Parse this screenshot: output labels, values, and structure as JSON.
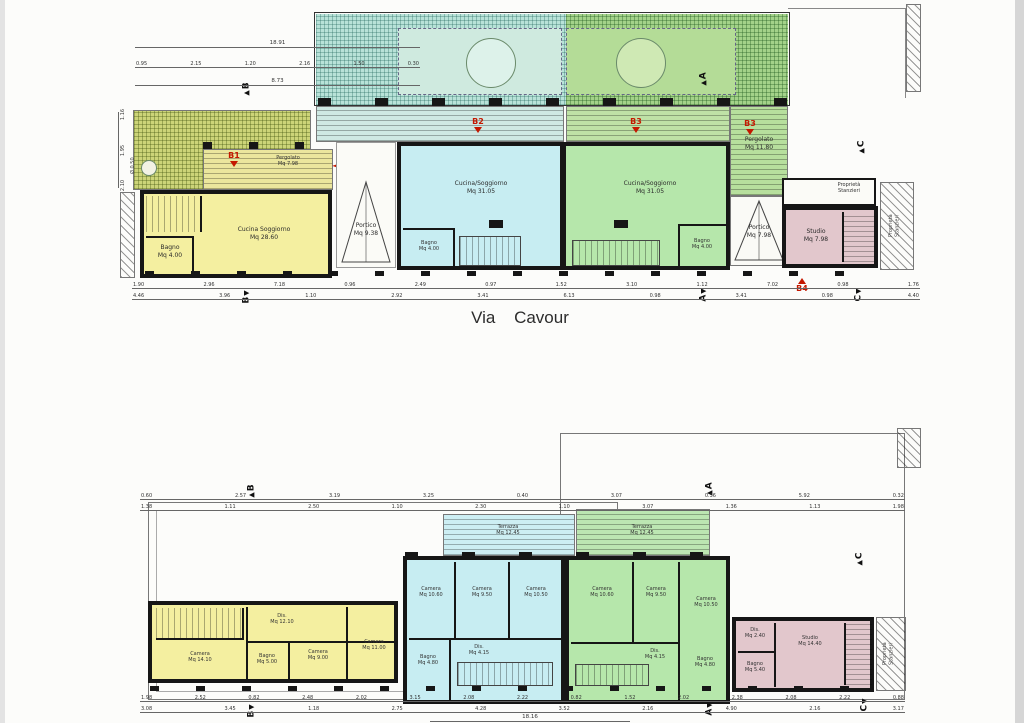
{
  "street": "Via Cavour",
  "sections": {
    "a": "A",
    "b": "B",
    "c": "C"
  },
  "unit_markers": {
    "b1": "B1",
    "b2": "B2",
    "b3": "B3",
    "b4": "B4"
  },
  "colors": {
    "unit_b1_yellow": "#f4efa0",
    "unit_b2_cyan": "#c7edf2",
    "unit_b3_green": "#b6e7ab",
    "unit_b4_pink": "#e2c7cc",
    "garden_green": "#a3d289",
    "garden_cyan": "#b8e2d8",
    "pergola_yellow": "#ccd478",
    "wall_black": "#161616",
    "marker_red": "#c41800"
  },
  "ground": {
    "b1_main": "Cucina Soggiorno\nMq 28.60",
    "b1_bagno": "Bagno\nMq 4.00",
    "b1_pergolato": "Pergolato\nMq 7.98",
    "b1_tree": "Ø 0.50",
    "portico_left": "Portico\nMq 9.38",
    "b2_main": "Cucina/Soggiorno\nMq 31.05",
    "b2_bagno": "Bagno\nMq 4.00",
    "b3_main": "Cucina/Soggiorno\nMq 31.05",
    "b3_bagno": "Bagno\nMq 4.00",
    "b3_pergolato": "Pergolato\nMq 11.80",
    "portico_right": "Portico\nMq 7.98",
    "b4_entry": "Proprietà\nStanzieri",
    "b4_studio": "Studio\nMq 7.98",
    "prop_right": "Proprietà\nStanzieri",
    "dim_total_top": "18.91",
    "dim_top_row": [
      "0.95",
      "2.15",
      "1.20",
      "2.16",
      "1.50",
      "0.30"
    ],
    "dim_top_sub": "8.73",
    "dim_left_col": [
      "1.16",
      "1.95",
      "2.10"
    ],
    "dim_bottom_row1": [
      "1.90",
      "2.96",
      "7.18",
      "0.96",
      "2.49",
      "0.97",
      "1.52",
      "3.10",
      "1.12",
      "7.02",
      "0.98",
      "1.76"
    ],
    "dim_bottom_row2": [
      "4.46",
      "3.96",
      "1.10",
      "2.92",
      "3.41",
      "6.13",
      "0.98",
      "3.41",
      "0.98",
      "4.40"
    ]
  },
  "first": {
    "terrace_b2": "Terrazza\nMq 12.45",
    "terrace_b3": "Terrazza\nMq 12.45",
    "y_dis": "Dis.\nMq 12.10",
    "y_camera1": "Camera\nMq 14.10",
    "y_bagno": "Bagno\nMq 5.00",
    "y_camera2": "Camera\nMq 9.00",
    "y_camera3": "Camera\nMq 11.00",
    "c_camera1": "Camera\nMq 10.60",
    "c_camera2": "Camera\nMq 9.50",
    "c_camera3": "Camera\nMq 10.50",
    "c_dis": "Dis.\nMq 4.15",
    "c_bagno": "Bagno\nMq 4.80",
    "g_camera1": "Camera\nMq 10.60",
    "g_camera2": "Camera\nMq 9.50",
    "g_camera3": "Camera\nMq 10.50",
    "g_dis": "Dis.\nMq 4.15",
    "g_bagno": "Bagno\nMq 4.80",
    "p_dis": "Dis.\nMq 2.40",
    "p_bagno": "Bagno\nMq 5.40",
    "p_studio": "Studio\nMq 14.40",
    "prop_right": "Proprietà\nStanzieri",
    "dim_top_row1": [
      "0.60",
      "2.57",
      "3.19",
      "3.25",
      "0.40",
      "3.07",
      "0.36",
      "5.92",
      "0.32"
    ],
    "dim_top_row2": [
      "1.38",
      "1.11",
      "2.50",
      "1.10",
      "2.30",
      "1.10",
      "3.07",
      "1.36",
      "1.13",
      "1.98"
    ],
    "dim_bottom_row1": [
      "1.98",
      "2.52",
      "0.82",
      "2.48",
      "2.02",
      "3.15",
      "2.08",
      "2.22",
      "0.82",
      "1.52",
      "2.02",
      "2.38",
      "2.08",
      "2.22",
      "0.88"
    ],
    "dim_bottom_row2": [
      "3.08",
      "3.45",
      "1.18",
      "2.75",
      "4.28",
      "3.52",
      "2.16",
      "4.90",
      "2.16",
      "3.17"
    ],
    "dim_total_bottom": "18.16"
  }
}
